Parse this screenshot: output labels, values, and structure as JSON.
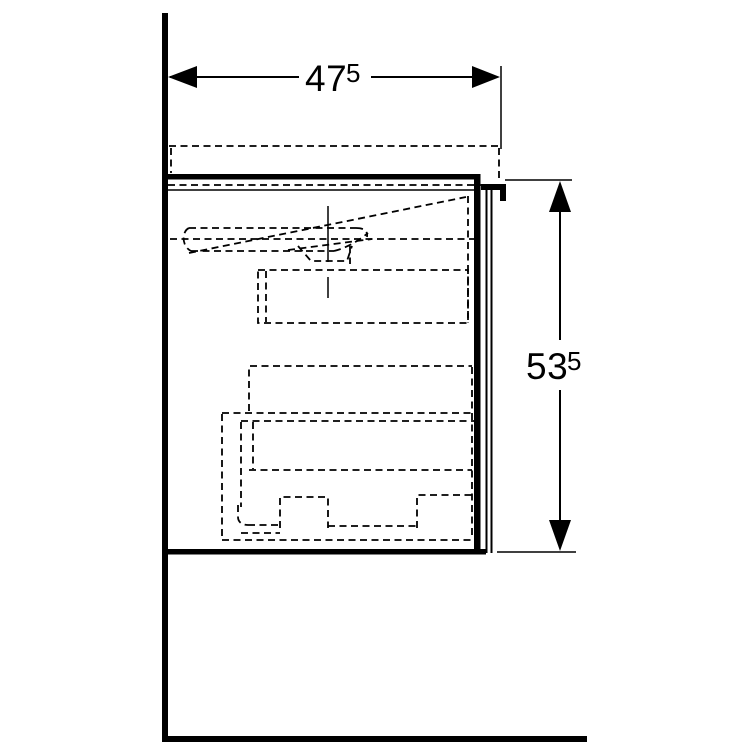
{
  "drawing": {
    "kind": "furniture-side-view-dimension-drawing",
    "dimensions": {
      "width": {
        "value": "47",
        "superscript": "5"
      },
      "height": {
        "value": "53",
        "superscript": "5"
      }
    }
  },
  "colors": {
    "line": "#000000",
    "background": "#ffffff"
  }
}
